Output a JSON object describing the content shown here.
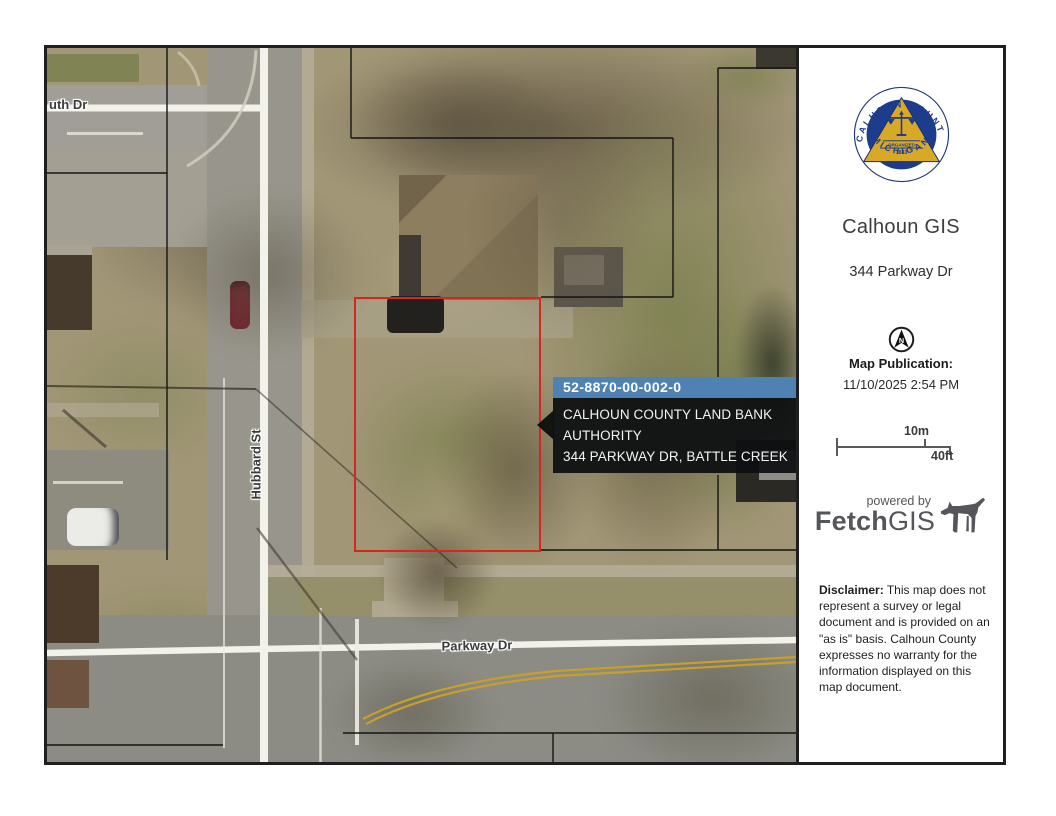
{
  "colors": {
    "parcel_outline": "#d3281e",
    "popup_header_bg": "#4e82b2",
    "popup_body_bg": "rgba(12,14,16,0.93)",
    "seal_navy": "#1e3c8c",
    "seal_gold": "#d8a827",
    "brand_gray": "#55565a"
  },
  "map": {
    "street_labels": {
      "top": "uth Dr",
      "vertical": "Hubbard St",
      "bottom": "Parkway Dr"
    },
    "popup": {
      "parcel_id": "52-8870-00-002-0",
      "line1": "CALHOUN COUNTY LAND BANK AUTHORITY",
      "line2": "344 PARKWAY DR, BATTLE CREEK"
    }
  },
  "sidebar": {
    "seal": {
      "arc_top": "CALHOUN COUNTY",
      "arc_bottom": "MICHIGAN",
      "band_line1": "ORGANIZED",
      "band_line2": "1833"
    },
    "title": "Calhoun GIS",
    "address": "344 Parkway Dr",
    "north": "N",
    "publication_label": "Map Publication:",
    "publication_value": "11/10/2025 2:54 PM",
    "scale_metric": "10m",
    "scale_imperial": "40ft",
    "powered_by": "powered by",
    "brand_bold": "Fetch",
    "brand_light": "GIS",
    "disclaimer_label": "Disclaimer:",
    "disclaimer_body": " This map does not represent a survey or legal document and is provided on an \"as is\" basis. Calhoun County expresses no warranty for the information displayed on this map document."
  }
}
